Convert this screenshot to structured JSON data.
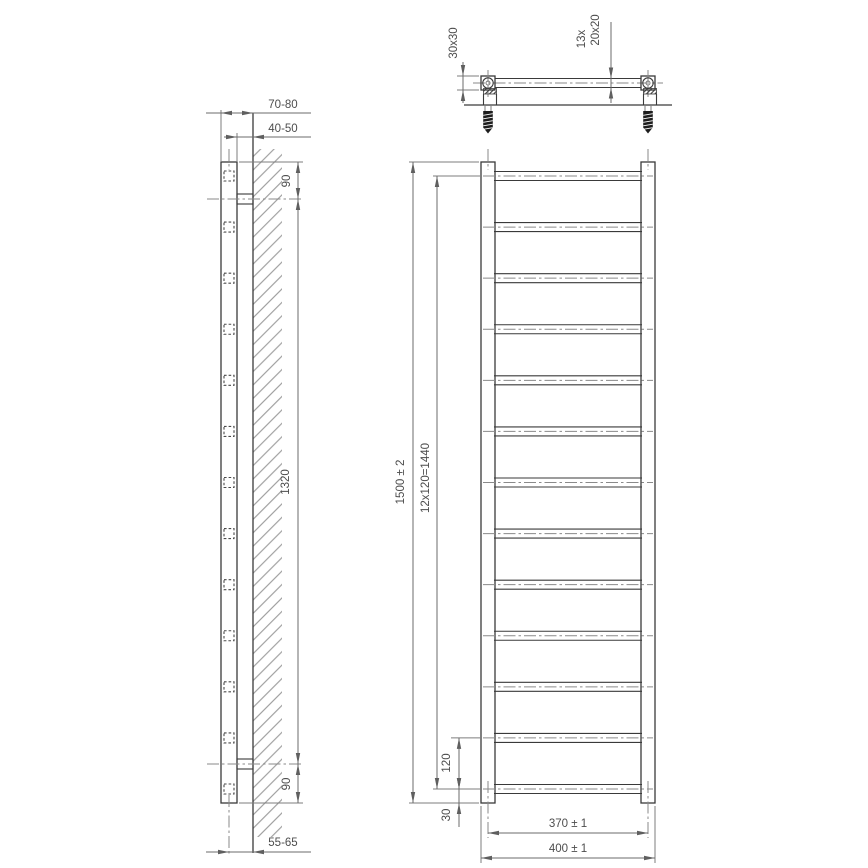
{
  "colors": {
    "object_line": "#3a3a3a",
    "dimension_line": "#6b6b6b",
    "label_text": "#4d4d4d",
    "hatch_line": "#8f8f8f"
  },
  "top_view": {
    "tube_profile": "30x30",
    "rung_count": "13x",
    "rung_profile": "20x20"
  },
  "side_view": {
    "wall_to_front": "70-80",
    "wall_to_back": "40-50",
    "top_bracket_offset": "90",
    "bracket_span": "1320",
    "bottom_bracket_offset": "90",
    "wall_to_axis": "55-65"
  },
  "front_view": {
    "total_height": "1500 ± 2",
    "rung_pitch": "12x120=1440",
    "last_rung_pitch": "120",
    "bottom_rung_offset": "30",
    "axis_width": "370 ± 1",
    "total_width": "400 ± 1"
  }
}
